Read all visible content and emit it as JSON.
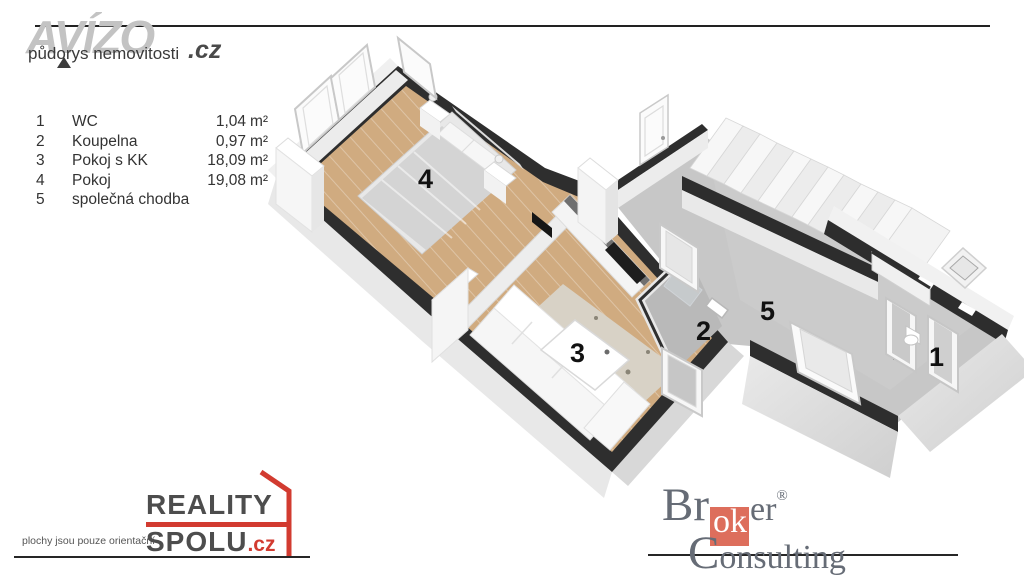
{
  "header": {
    "brand": "AVÍZO",
    "brand_tld": ".cz",
    "subtitle": "půdorys nemovitosti"
  },
  "legend": {
    "rows": [
      {
        "num": "1",
        "name": "WC",
        "area": "1,04",
        "unit": "m²"
      },
      {
        "num": "2",
        "name": "Koupelna",
        "area": "0,97",
        "unit": "m²"
      },
      {
        "num": "3",
        "name": "Pokoj s KK",
        "area": "18,09",
        "unit": "m²"
      },
      {
        "num": "4",
        "name": "Pokoj",
        "area": "19,08",
        "unit": "m²"
      },
      {
        "num": "5",
        "name": "společná chodba",
        "area": "",
        "unit": ""
      }
    ]
  },
  "plan": {
    "rooms": [
      {
        "number": "1",
        "name": "WC"
      },
      {
        "number": "2",
        "name": "Koupelna"
      },
      {
        "number": "3",
        "name": "Pokoj s KK"
      },
      {
        "number": "4",
        "name": "Pokoj"
      },
      {
        "number": "5",
        "name": "společná chodba"
      }
    ]
  },
  "footer": {
    "note": "plochy jsou pouze orientační",
    "reality": {
      "line1": "REALITY",
      "line2": "SPOLU",
      "tld": ".cz"
    },
    "broker": {
      "b1": "Br",
      "b2": "ok",
      "b3": "er",
      "reg": "®",
      "c1": "C",
      "c2": "onsulting"
    }
  },
  "colors": {
    "accent_red": "#d23b30",
    "broker_salmon": "#dd6e5c",
    "wall_dark": "#2e2e2e",
    "wood_floor": "#d0ab80",
    "concrete_floor": "#c7c7c7",
    "logo_gray": "#c3c3c3",
    "text_dark": "#333333"
  }
}
